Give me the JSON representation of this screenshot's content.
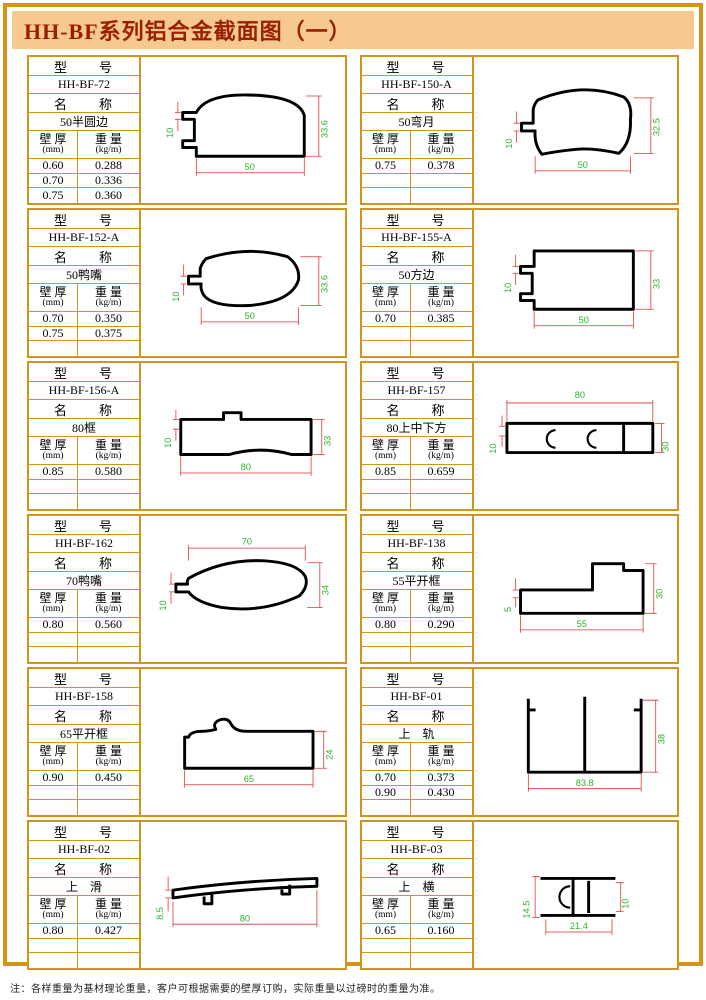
{
  "title": "HH-BF系列铝合金截面图（一）",
  "labels": {
    "model": "型　　号",
    "name": "名　　称",
    "thickness": "壁 厚",
    "thickness_unit": "(mm)",
    "weight": "重 量",
    "weight_unit": "(kg/m)"
  },
  "colors": {
    "border_orange": "#d4941c",
    "title_bg": "#f6c98e",
    "title_text": "#9c1e00",
    "dim_line_red": "#e03333",
    "dim_text_green": "#2db32d"
  },
  "cells": [
    {
      "model": "HH-BF-72",
      "name": "50半圆边",
      "rows": [
        [
          "0.60",
          "0.288"
        ],
        [
          "0.70",
          "0.336"
        ],
        [
          "0.75",
          "0.360"
        ]
      ],
      "dims": {
        "left": "10",
        "bottom": "50",
        "right": "33.6"
      }
    },
    {
      "model": "HH-BF-150-A",
      "name": "50弯月",
      "rows": [
        [
          "0.75",
          "0.378"
        ],
        [
          "",
          ""
        ],
        [
          "",
          ""
        ]
      ],
      "dims": {
        "left": "10",
        "bottom": "50",
        "right": "32.5"
      }
    },
    {
      "model": "HH-BF-152-A",
      "name": "50鸭嘴",
      "rows": [
        [
          "0.70",
          "0.350"
        ],
        [
          "0.75",
          "0.375"
        ],
        [
          "",
          ""
        ]
      ],
      "dims": {
        "left": "10",
        "bottom": "50",
        "right": "33.6"
      }
    },
    {
      "model": "HH-BF-155-A",
      "name": "50方边",
      "rows": [
        [
          "0.70",
          "0.385"
        ],
        [
          "",
          ""
        ],
        [
          "",
          ""
        ]
      ],
      "dims": {
        "left": "10",
        "bottom": "50",
        "right": "33"
      }
    },
    {
      "model": "HH-BF-156-A",
      "name": "80框",
      "rows": [
        [
          "0.85",
          "0.580"
        ],
        [
          "",
          ""
        ],
        [
          "",
          ""
        ]
      ],
      "dims": {
        "left": "10",
        "bottom": "80",
        "right": "33"
      }
    },
    {
      "model": "HH-BF-157",
      "name": "80上中下方",
      "rows": [
        [
          "0.85",
          "0.659"
        ],
        [
          "",
          ""
        ],
        [
          "",
          ""
        ]
      ],
      "dims": {
        "left": "10",
        "top": "80",
        "right": "30"
      }
    },
    {
      "model": "HH-BF-162",
      "name": "70鸭嘴",
      "rows": [
        [
          "0.80",
          "0.560"
        ],
        [
          "",
          ""
        ],
        [
          "",
          ""
        ]
      ],
      "dims": {
        "left": "10",
        "top": "70",
        "right": "34"
      }
    },
    {
      "model": "HH-BF-138",
      "name": "55平开框",
      "rows": [
        [
          "0.80",
          "0.290"
        ],
        [
          "",
          ""
        ],
        [
          "",
          ""
        ]
      ],
      "dims": {
        "left": "5",
        "bottom": "55",
        "right": "30"
      }
    },
    {
      "model": "HH-BF-158",
      "name": "65平开框",
      "rows": [
        [
          "0.90",
          "0.450"
        ],
        [
          "",
          ""
        ],
        [
          "",
          ""
        ]
      ],
      "dims": {
        "bottom": "65",
        "right": "24"
      }
    },
    {
      "model": "HH-BF-01",
      "name": "上　轨",
      "rows": [
        [
          "0.70",
          "0.373"
        ],
        [
          "0.90",
          "0.430"
        ],
        [
          "",
          ""
        ]
      ],
      "dims": {
        "bottom": "83.8",
        "right": "38"
      }
    },
    {
      "model": "HH-BF-02",
      "name": "上　滑",
      "rows": [
        [
          "0.80",
          "0.427"
        ],
        [
          "",
          ""
        ],
        [
          "",
          ""
        ]
      ],
      "dims": {
        "left": "8.5",
        "bottom": "80"
      }
    },
    {
      "model": "HH-BF-03",
      "name": "上　横",
      "rows": [
        [
          "0.65",
          "0.160"
        ],
        [
          "",
          ""
        ],
        [
          "",
          ""
        ]
      ],
      "dims": {
        "left": "14.5",
        "right": "10",
        "bottom": "21.4"
      }
    }
  ],
  "footnote": "注：各样重量为基材理论重量，客户可根据需要的壁厚订购，实际重量以过磅时的重量为准。"
}
